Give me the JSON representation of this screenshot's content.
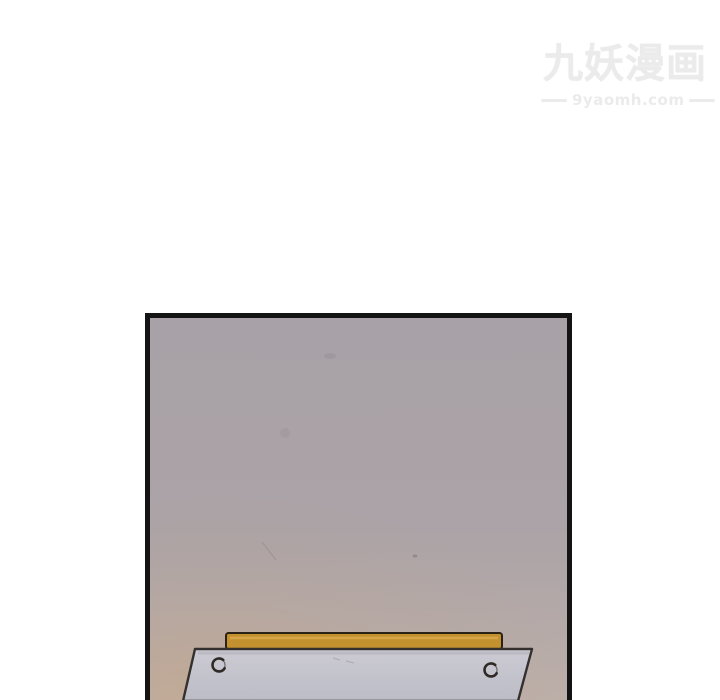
{
  "watermark": {
    "title": "九妖漫画",
    "url": "9yaomh.com",
    "color": "#ebebeb"
  },
  "panel": {
    "border_color": "#141414"
  },
  "wall": {
    "top_color": "#a8a1a7",
    "mid_color": "#aba3a7",
    "bottom_color": "#bcafa9",
    "warm_tint": "#c9a178"
  },
  "desk": {
    "tabletop_edge_color": "#c3912d",
    "tabletop_edge_highlight": "#dcae52",
    "tabletop_edge_outline": "#2b2217",
    "board_fill_top": "#cccbd4",
    "board_fill_bottom": "#bcbcc6",
    "board_outline": "#33302d",
    "screw_ring": "#6b6460",
    "screw_mark": "#2f2a26"
  }
}
